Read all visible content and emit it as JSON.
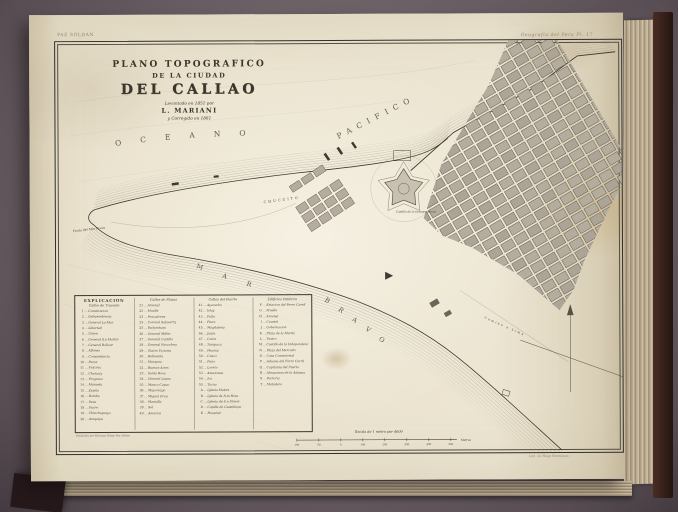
{
  "frame": {
    "plate_label_left": "PAZ SOLDAN",
    "plate_label_right": "Geografia del Peru Pl. 17",
    "imprint_left": "Publicado por Mariano Felipe Paz Soldan",
    "imprint_right": "Lith. de Hage Hermanos"
  },
  "title": {
    "line1": "PLANO TOPOGRAFICO",
    "line2": "DE LA CIUDAD",
    "line3": "DEL CALLAO",
    "line4": "Levantado en 1851 por",
    "line5": "L. MARIANI",
    "line6": "y Corregido en 1861"
  },
  "water_labels": {
    "oceano": "OCEANO",
    "pacifico": "PACIFICO",
    "mar": "MAR",
    "bravo": "BRAVO",
    "punta": "Punta del Mar Brava"
  },
  "land_labels": {
    "chucuito": "CHUCUITO",
    "castillo": "Castillo de la Independencia",
    "camino": "Camino a Lima"
  },
  "legend": {
    "title": "EXPLICACION",
    "columns": [
      {
        "header": "Calles de Travesia",
        "items": [
          [
            "1",
            "Constitucion"
          ],
          [
            "2",
            "Independencia"
          ],
          [
            "3",
            "General La-Mar"
          ],
          [
            "4",
            "Libertad"
          ],
          [
            "5",
            "Union"
          ],
          [
            "6",
            "General S.n Martin"
          ],
          [
            "7",
            "General Bolivar"
          ],
          [
            "8",
            "Alfonso"
          ],
          [
            "9",
            "Comandancia"
          ],
          [
            "10",
            "Pazos"
          ],
          [
            "11",
            "Victoria"
          ],
          [
            "12",
            "Chancay"
          ],
          [
            "13",
            "Progreso"
          ],
          [
            "14",
            "Manuela"
          ],
          [
            "15",
            "Zepita"
          ],
          [
            "16",
            "Bomba"
          ],
          [
            "17",
            "Pena"
          ],
          [
            "18",
            "Sucre"
          ],
          [
            "19",
            "Chinchaysuyo"
          ],
          [
            "20",
            "Arequipa"
          ]
        ]
      },
      {
        "header": "Calles de Plazas",
        "items": [
          [
            "21",
            "Arsenal"
          ],
          [
            "22",
            "Muelle"
          ],
          [
            "23",
            "Pescadores"
          ],
          [
            "24",
            "Coronel Salaverry"
          ],
          [
            "25",
            "Packenham"
          ],
          [
            "26",
            "General Miller"
          ],
          [
            "27",
            "General Castilla"
          ],
          [
            "28",
            "General Necochea"
          ],
          [
            "29",
            "Teatro Victoria"
          ],
          [
            "30",
            "Bellavista"
          ],
          [
            "31",
            "Marquez"
          ],
          [
            "32",
            "Buenos Aires"
          ],
          [
            "33",
            "Santa Rosa"
          ],
          [
            "34",
            "General Lopez"
          ],
          [
            "35",
            "Manco Capac"
          ],
          [
            "36",
            "Mayorazgo"
          ],
          [
            "37",
            "Miguel Grau"
          ],
          [
            "38",
            "Mansilla"
          ],
          [
            "39",
            "Sol"
          ],
          [
            "40",
            "America"
          ]
        ]
      },
      {
        "header": "Calles del Puerto",
        "items": [
          [
            "41",
            "Ayacucho"
          ],
          [
            "42",
            "Islay"
          ],
          [
            "43",
            "Paita"
          ],
          [
            "44",
            "Piura"
          ],
          [
            "45",
            "Magdalena"
          ],
          [
            "46",
            "Junin"
          ],
          [
            "47",
            "Colon"
          ],
          [
            "48",
            "Tarapaca"
          ],
          [
            "49",
            "Huaraz"
          ],
          [
            "50",
            "Cuzco"
          ],
          [
            "51",
            "Puno"
          ],
          [
            "52",
            "Loreto"
          ],
          [
            "53",
            "Amazonas"
          ],
          [
            "54",
            "Ica"
          ],
          [
            "55",
            "Tacna"
          ],
          [
            "A",
            "Iglesia Matriz"
          ],
          [
            "B",
            "Iglesia de S.ta Rosa"
          ],
          [
            "C",
            "Iglesia de S.n Simon"
          ],
          [
            "D",
            "Capilla de Guadalupe"
          ],
          [
            "E",
            "Hospital"
          ]
        ]
      },
      {
        "header": "Edificios Publicos",
        "items": [
          [
            "F",
            "Estacion del Ferro Carril"
          ],
          [
            "G",
            "Muelle"
          ],
          [
            "H",
            "Arsenal"
          ],
          [
            "I",
            "Cuartel"
          ],
          [
            "J",
            "Gobernacion"
          ],
          [
            "K",
            "Plaza de la Matriz"
          ],
          [
            "L",
            "Teatro"
          ],
          [
            "M",
            "Castillo de la Independencia"
          ],
          [
            "N",
            "Plaza del Mercado"
          ],
          [
            "O",
            "Casa Consistorial"
          ],
          [
            "P",
            "Aduana del Ferro Carril"
          ],
          [
            "Q",
            "Capitania del Puerto"
          ],
          [
            "R",
            "Almacenes de la Aduana"
          ],
          [
            "S",
            "Factoria"
          ],
          [
            "T",
            "Matadero"
          ]
        ]
      }
    ]
  },
  "scale": {
    "label": "Escala de 1 metro por 4000",
    "ticks": [
      "100",
      "50",
      "0",
      "100",
      "200",
      "300",
      "400",
      "500"
    ],
    "unit": "Metros"
  },
  "colors": {
    "background": "#6a5f66",
    "page": "#eae2cd",
    "ink": "#3f3a31",
    "block_fill": "#b4ac9d",
    "water_line": "#8f887a",
    "cover": "#3a241e"
  }
}
